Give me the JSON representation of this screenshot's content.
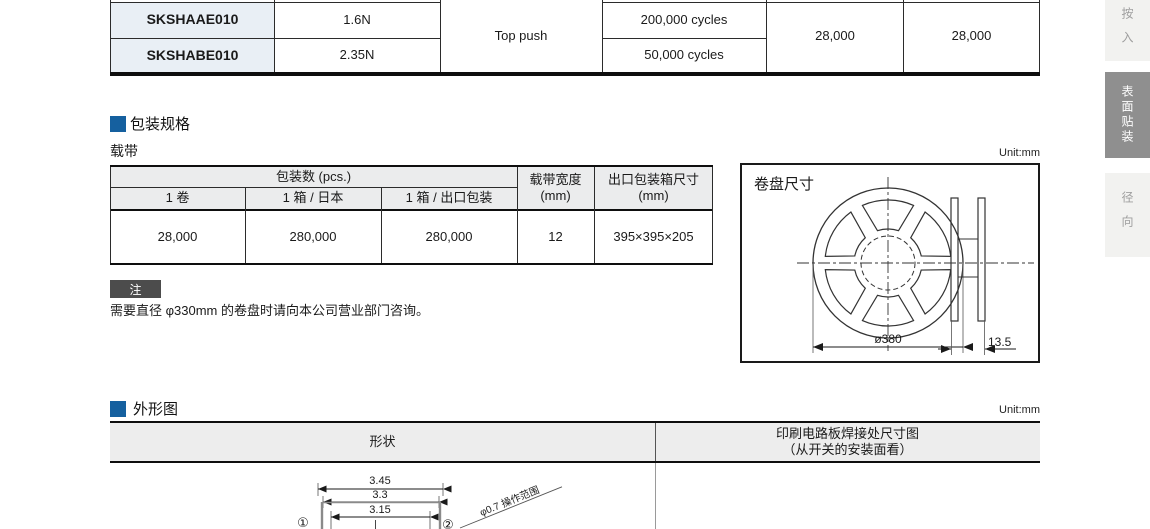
{
  "top_table": {
    "rows": [
      {
        "part_no": "SKSHAAE010",
        "operating_force": "1.6N",
        "life": "200,000 cycles"
      },
      {
        "part_no": "SKSHABE010",
        "operating_force": "2.35N",
        "life": "50,000 cycles"
      }
    ],
    "operating_direction": "Top push",
    "qty_a": "28,000",
    "qty_b": "28,000"
  },
  "sidebar": {
    "tabs": [
      {
        "label": "按入",
        "active": false
      },
      {
        "label": "表面贴装",
        "active": true
      },
      {
        "label": "径向",
        "active": false
      }
    ]
  },
  "packaging": {
    "section_title": "包装规格",
    "subtitle": "载带",
    "unit_label": "Unit:mm",
    "table": {
      "group_header": "包装数 (pcs.)",
      "col_reel": "1 卷",
      "col_japan": "1 箱 / 日本",
      "col_export": "1 箱 / 出口包装",
      "col_tape_width_line1": "载带宽度",
      "col_tape_width_line2": "(mm)",
      "col_box_line1": "出口包装箱尺寸",
      "col_box_line2": "(mm)",
      "row": {
        "reel": "28,000",
        "japan": "280,000",
        "export": "280,000",
        "tape_width": "12",
        "box_size": "395×395×205"
      }
    },
    "note_badge": "注",
    "note_text": "需要直径 φ330mm 的卷盘时请向本公司营业部门咨询。"
  },
  "reel": {
    "title": "卷盘尺寸",
    "diameter_label": "ø380",
    "width_label": "13.5"
  },
  "outline": {
    "section_title": "外形图",
    "unit_label": "Unit:mm",
    "col_shape": "形状",
    "col_pcb_line1": "印刷电路板焊接处尺寸图",
    "col_pcb_line2": "（从开关的安装面看）",
    "dim_345": "3.45",
    "dim_33": "3.3",
    "dim_315": "3.15",
    "callout_1": "①",
    "callout_2": "②",
    "op_range_label": "φ0.7 操作范围"
  },
  "colors": {
    "accent_blue": "#15609f",
    "table_header_bg": "#ebeced",
    "part_column_bg": "#e9eff5",
    "sidebar_active_bg": "#8f8f8f",
    "sidebar_inactive_bg": "#f2f2f0",
    "note_badge_bg": "#4c4c4c"
  }
}
